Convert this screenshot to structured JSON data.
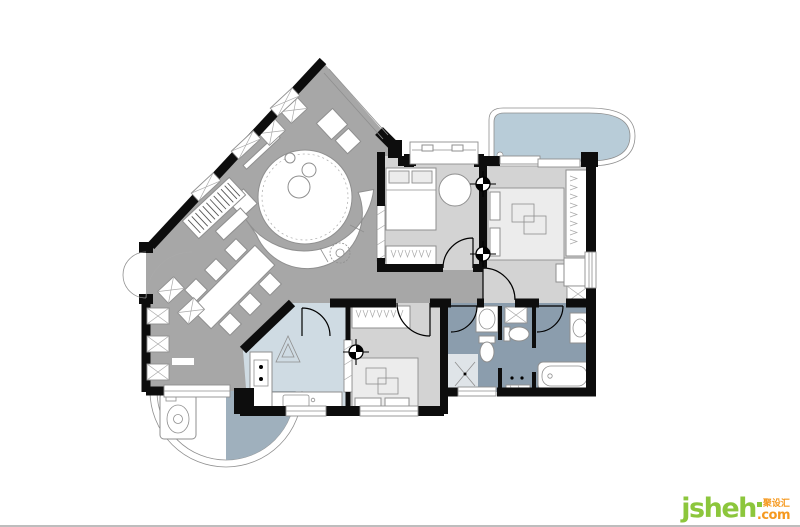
{
  "watermark": {
    "brand": "jsheh",
    "tld": ".com",
    "cjk": "聚设汇",
    "brand_color": "#8cc63c",
    "accent_color": "#f5991f"
  },
  "palette": {
    "background": "#ffffff",
    "wall": "#0d0d0d",
    "living_floor": "#a7a7a7",
    "bedroom_floor": "#d3d3d3",
    "bath_floor": "#8b9dad",
    "kitchen_floor": "#cfdbe3",
    "balcony_fill": "#b8ccd8",
    "balcony_floor": "#9fb0bd",
    "outline": "#8f8f8f",
    "furniture": "#ffffff",
    "divider": "#bdbdbd"
  }
}
